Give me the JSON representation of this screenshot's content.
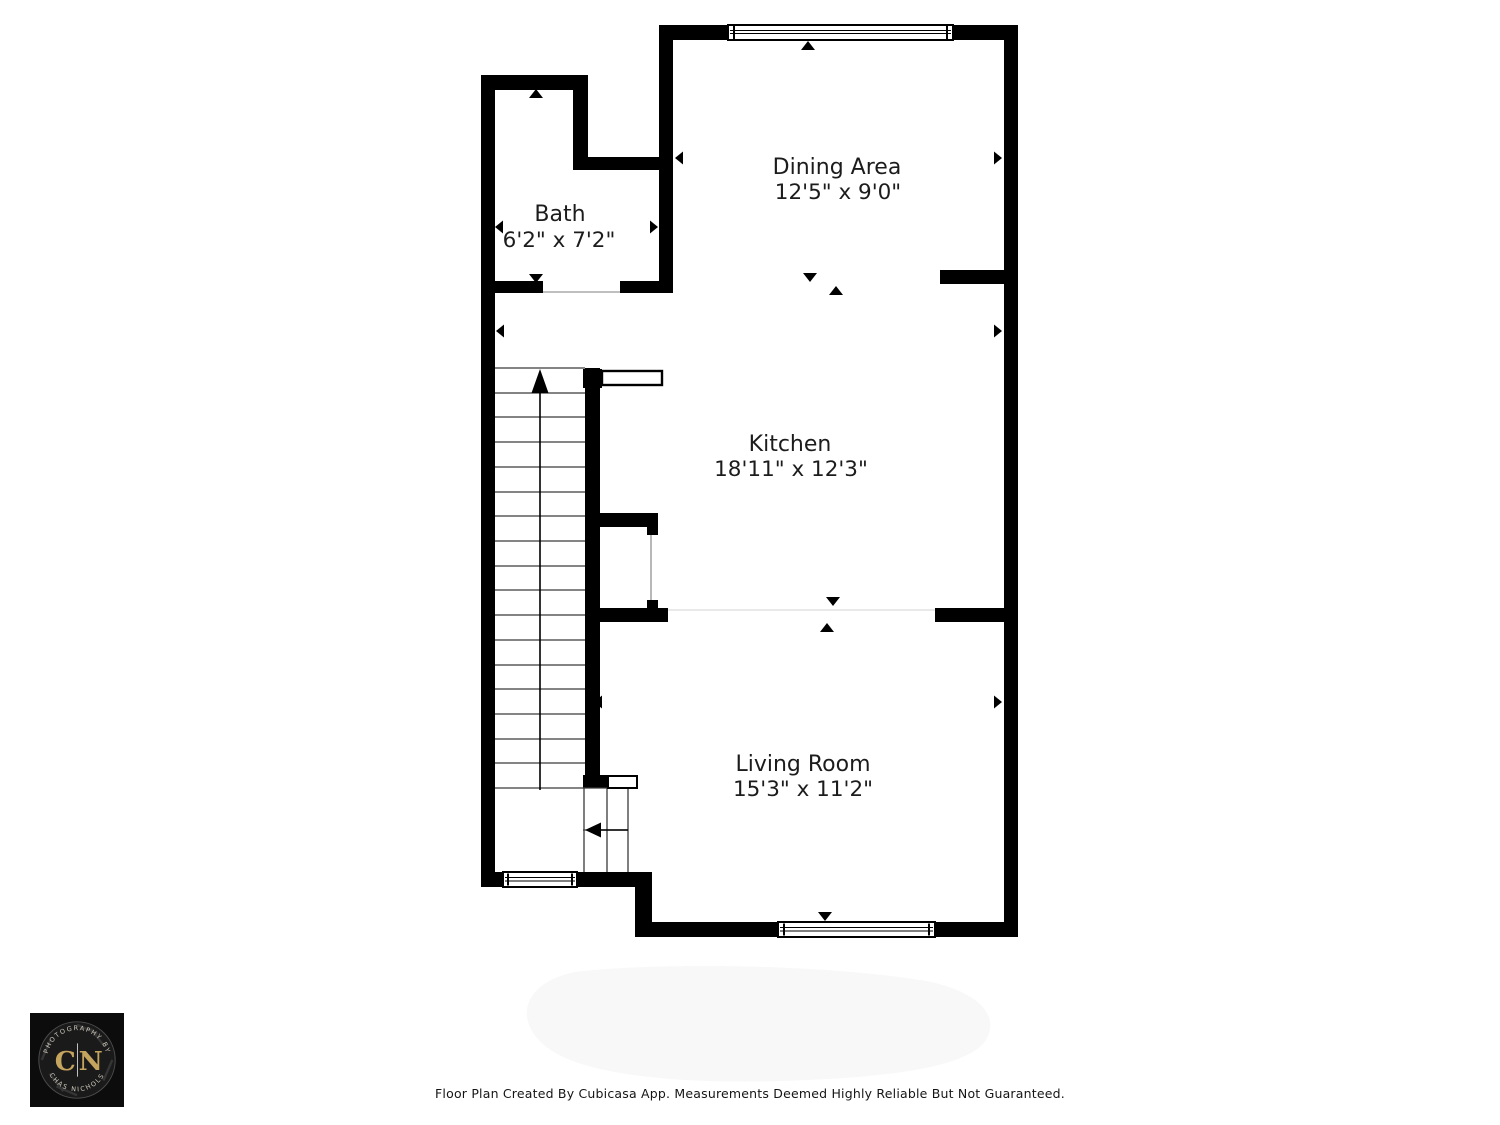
{
  "page": {
    "background": "#ffffff",
    "footer_text": "Floor Plan Created By Cubicasa App. Measurements Deemed Highly Reliable But Not Guaranteed."
  },
  "floor_plan": {
    "wall_color": "#000000",
    "label_color": "#1c1c1c",
    "rooms": [
      {
        "id": "bath",
        "name": "Bath",
        "dimensions": "6'2\" x 7'2\""
      },
      {
        "id": "dining",
        "name": "Dining Area",
        "dimensions": "12'5\" x 9'0\""
      },
      {
        "id": "kitchen",
        "name": "Kitchen",
        "dimensions": "18'11\" x 12'3\""
      },
      {
        "id": "living",
        "name": "Living Room",
        "dimensions": "15'3\" x 11'2\""
      }
    ]
  },
  "logo": {
    "arc_top": "PHOTOGRAPHY BY",
    "arc_bottom": "CHAS NICHOLS",
    "monogram_left": "C",
    "monogram_right": "N",
    "gold": "#c5a45e"
  }
}
